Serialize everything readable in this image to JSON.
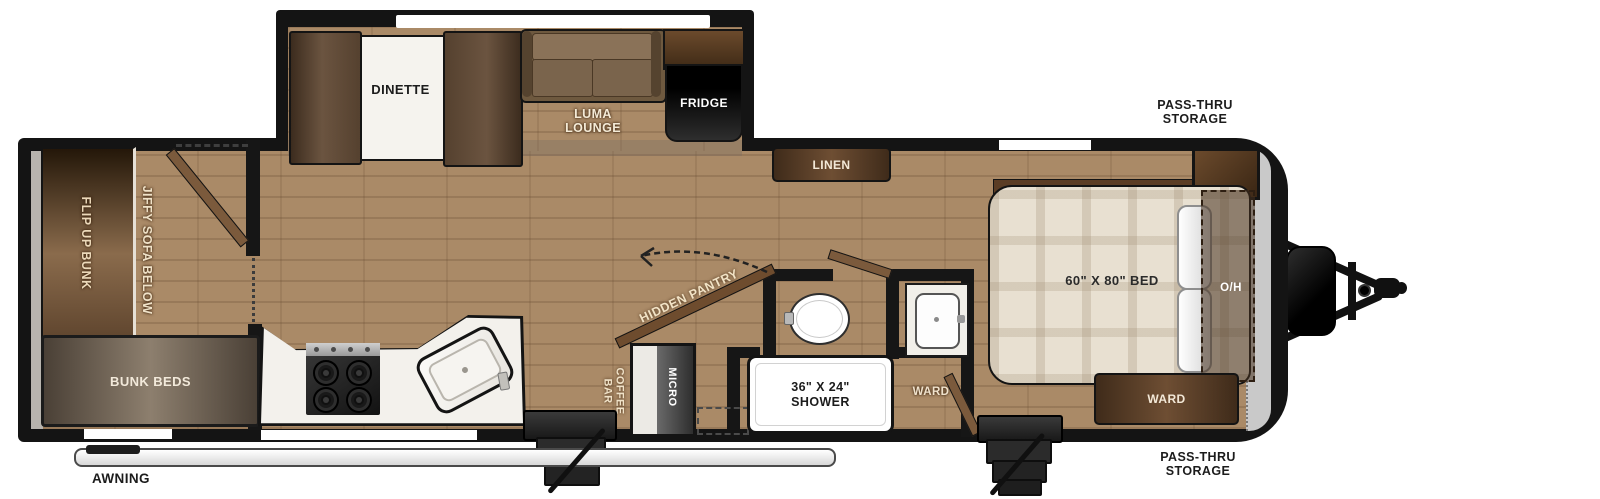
{
  "slideout": {
    "dinette_label": "DINETTE",
    "luma_lounge_label": "LUMA LOUNGE",
    "fridge_label": "FRIDGE"
  },
  "bunk_room": {
    "flip_up_bunk_label": "FLIP UP BUNK",
    "jiffy_sofa_label": "JIFFY SOFA BELOW",
    "bunk_beds_label": "BUNK BEDS"
  },
  "hall": {
    "linen_label": "LINEN",
    "hidden_pantry_label": "HIDDEN PANTRY",
    "coffee_bar_label": "COFFEE BAR",
    "micro_label": "MICRO"
  },
  "bathroom": {
    "shower_label": "36\" X 24\" SHOWER",
    "ward_label": "WARD"
  },
  "bedroom": {
    "bed_label": "60\" X 80\" BED",
    "overhead_label": "O/H",
    "ward_label": "WARD"
  },
  "exterior": {
    "awning_label": "AWNING",
    "pass_thru_top_label": "PASS-THRU STORAGE",
    "pass_thru_bottom_label": "PASS-THRU STORAGE"
  },
  "colors": {
    "floor": "#aa8a67",
    "wall": "#161616",
    "cabinet_brown": "#5e4128",
    "counter_white": "#f3f1ec",
    "label_cream": "#f2e6d0",
    "mattress": "#e8e0d1",
    "pass_thru_gray": "#c9c9c9"
  }
}
